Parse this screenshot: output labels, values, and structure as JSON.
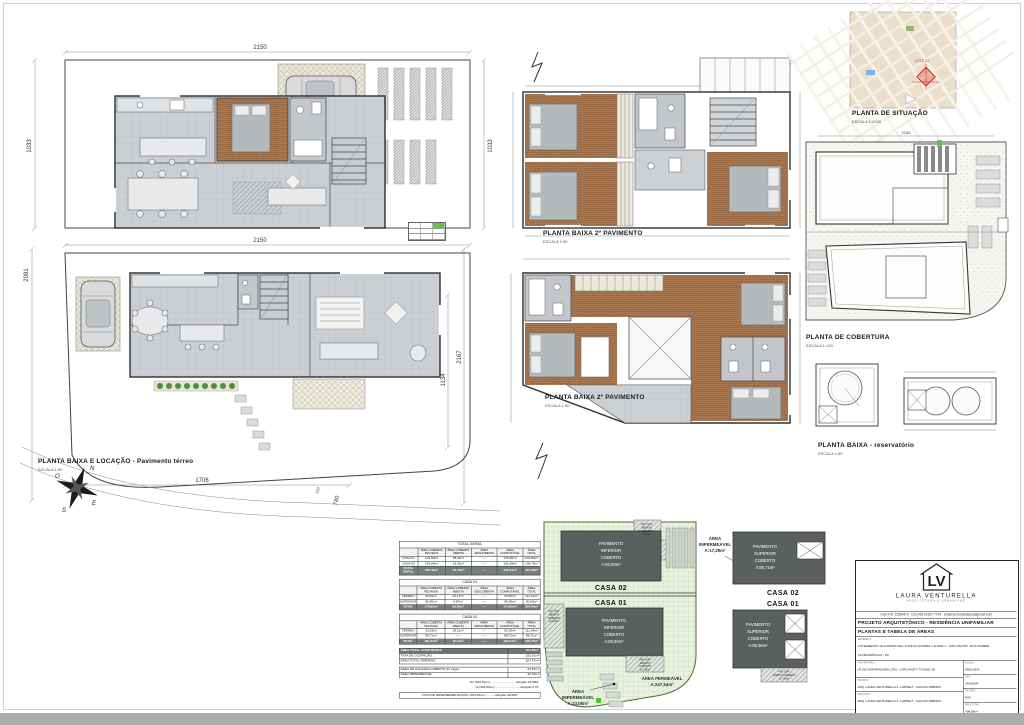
{
  "colors": {
    "wood_floor": "#ab7951",
    "tile_floor": "#ccd0d4",
    "dark_block": "#5b605f",
    "green_lot": "#e9f2de",
    "highlight_green": "#57c23d",
    "marker_red": "#cc2a22"
  },
  "labels": {
    "plan1_title": "PLANTA BAIXA E LOCAÇÃO - Pavimento térreo",
    "plan1_scale": "ESCALA 1:50",
    "pav2_title": "PLANTA BAIXA 2º PAVIMENTO",
    "pav2_scale": "ESCALA 1:50",
    "situacao_title": "PLANTA DE SITUAÇÃO",
    "situacao_scale": "ESCALA 1:2000",
    "cobertura_title": "PLANTA DE COBERTURA",
    "cobertura_scale": "ESCALA 1:100",
    "reservatorio_title": "PLANTA BAIXA - reservatório",
    "reservatorio_scale": "ESCALA 1:50"
  },
  "dims": {
    "d2150": "2150",
    "d1033": "1033",
    "d2081": "2081",
    "d2167": "2167",
    "d1134": "1134",
    "d1706": "1706",
    "d740": "740",
    "d100": "100"
  },
  "compass": {
    "n": "N",
    "o": "O",
    "s": "S",
    "e": "E"
  },
  "situacao": {
    "marker": "LOTE 02"
  },
  "green_diagram": {
    "casa02_lines": [
      "PAVIMENTO",
      "INFERIOR",
      "COBERTO",
      "A:92,93m²"
    ],
    "casa01_lines": [
      "PAVIMENTO",
      "INFERIOR",
      "COBERTO",
      "A:90,84m²"
    ],
    "hatch_top_lines": [
      "PAV. SUP.",
      "ABERTO",
      "COBERTO",
      "A:9,06m²"
    ],
    "hatch_left_lines": [
      "PAV. SUP.",
      "ABERTO",
      "COBERTO",
      "A:8,06m²"
    ],
    "hatch_bottom_lines": [
      "PAV. SUP.",
      "ABERTO",
      "COBERTO",
      "A:7,55m²"
    ],
    "casa02_label": "CASA 02",
    "casa01_label": "CASA 01",
    "permeavel": [
      "ÁREA PERMEÁVEL",
      "A:247,54m²"
    ],
    "impermeavel": [
      "ÁREA",
      "IMPERMEÁVEL",
      "A:23,05m²"
    ]
  },
  "grey_diagram": {
    "impermeavel": [
      "ÁREA",
      "IMPERMEÁVEL",
      "A:17,29m²"
    ],
    "casa02_lines": [
      "PAVIMENTO",
      "SUPERIOR",
      "COBERTO",
      "A:88,71m²"
    ],
    "casa01_lines": [
      "PAVIMENTO",
      "SUPERIOR",
      "COBERTO",
      "A:85,96m²"
    ],
    "hatch_bottom_lines": [
      "PAV. SUP.",
      "ABERTO COBERTO",
      "A:7,55m²"
    ],
    "casa02_label": "CASA 02",
    "casa01_label": "CASA 01"
  },
  "tables": {
    "headers": [
      "",
      "ÁREA COBERTA FECHADA",
      "ÁREA COBERTA ABERTA",
      "ÁREA DESCOBERTA",
      "ÁREA COMPUTÁVEL",
      "ÁREA TOTAL"
    ],
    "total_geral": {
      "title": "TOTAL GERAL",
      "rows": [
        [
          "CASA 01",
          "176,80m²",
          "28,04m²",
          "----",
          "176,80m²",
          "204,84m²"
        ],
        [
          "CASA 02",
          "181,64m²",
          "18,11m²",
          "----",
          "181,64m²",
          "199,75m²"
        ],
        [
          "TOTAL GERAL",
          "358,44m²",
          "46,15m²",
          "----",
          "358,44m²",
          "404,59m²"
        ]
      ]
    },
    "casa01": {
      "title": "CASA 01",
      "rows": [
        [
          "TÉRREO",
          "90,84m²",
          "23,17m²",
          "----",
          "90,84m²",
          "114,01m²"
        ],
        [
          "SUPERIOR",
          "85,96m²",
          "4,87m²",
          "----",
          "85,96m²",
          "90,83m²"
        ],
        [
          "TOTAL",
          "176,80m²",
          "28,04m²",
          "----",
          "176,80m²",
          "204,84m²"
        ]
      ]
    },
    "casa02": {
      "title": "CASA 02",
      "rows": [
        [
          "TÉRREO",
          "92,93m²",
          "18,11m²",
          "----",
          "92,93m²",
          "111,04m²"
        ],
        [
          "SUPERIOR",
          "88,71m²",
          "----",
          "----",
          "88,71m²",
          "88,71m²"
        ],
        [
          "TOTAL",
          "181,64m²",
          "18,11m²",
          "----",
          "181,64m²",
          "199,75m²"
        ]
      ]
    },
    "resumo": {
      "rows": [
        [
          "ÁREA TOTAL CONSTRUÍDA",
          "404,59m²"
        ],
        [
          "TAXA DE OCUPAÇÃO",
          "232,01m²"
        ],
        [
          "ÁREA TOTAL TERRENO",
          "527,47m²"
        ]
      ],
      "rows2": [
        [
          "ÁREA DE CALÇADA COBERTA (C/ vaga)",
          "29,52m²"
        ],
        [
          "ÁREA IMPERMEÁVEL",
          "40,34m²"
        ]
      ],
      "notes": [
        "TO (232,01m²)..............................atingido 43,98%",
        "IA (404,59m²)..............................atingido 0,76"
      ],
      "note_box": "TAXA DE IMPERMEABILIZAÇÃO (263,53m²)............atingido 49,96%"
    }
  },
  "title_block": {
    "logo_text": "LV",
    "studio_name": "LAURA VENTURELLA",
    "studio_sub": "ARQUITETURA E URBANISMO",
    "contact": "CAU-RS: 155845-5 - Cel.(48) 99157-7734 - email:venturellalaura@gmail.com",
    "project_title": "PROJETO ARQUITETÔNICO - RESIDÊNCIA UNIFAMILIAR",
    "sheet_content": "PLANTAS E TABELA DE ÁREAS",
    "address_label": "ENDEREÇO:",
    "address": "LOTEAMENTO VILA PAMPLONA, LOTE 02 QUADRA J, ETAPA 1 - VIAS (25) R/N - RUA TAUBER - FLORIANÓPOLIS - SC",
    "owner_label": "PROPRIETÁRIO:",
    "owner": "LR INCORPORADORA LTDA - CNPJ:44.877.771/0001-55",
    "project_label": "PROJETO:",
    "project_author": "ARQ. LAURA VENTURELLA A. LOPPELT - CAU-RS 155845-5",
    "exec_label": "EXECUÇÃO:",
    "exec_author": "ARQ. LAURA VENTURELLA A. LOPPELT - CAU-RS 155845-5",
    "escala_label": "ESCALA:",
    "escala": "INDICADA",
    "data_label": "DATA:",
    "data": "JAN/2024",
    "rev_label": "REVISÃO:",
    "rev": "R04",
    "area_label": "ÁREA TOTAL:",
    "area": "404,59m²",
    "prancha_label": "PRANCHA:",
    "prancha": "01/03"
  }
}
